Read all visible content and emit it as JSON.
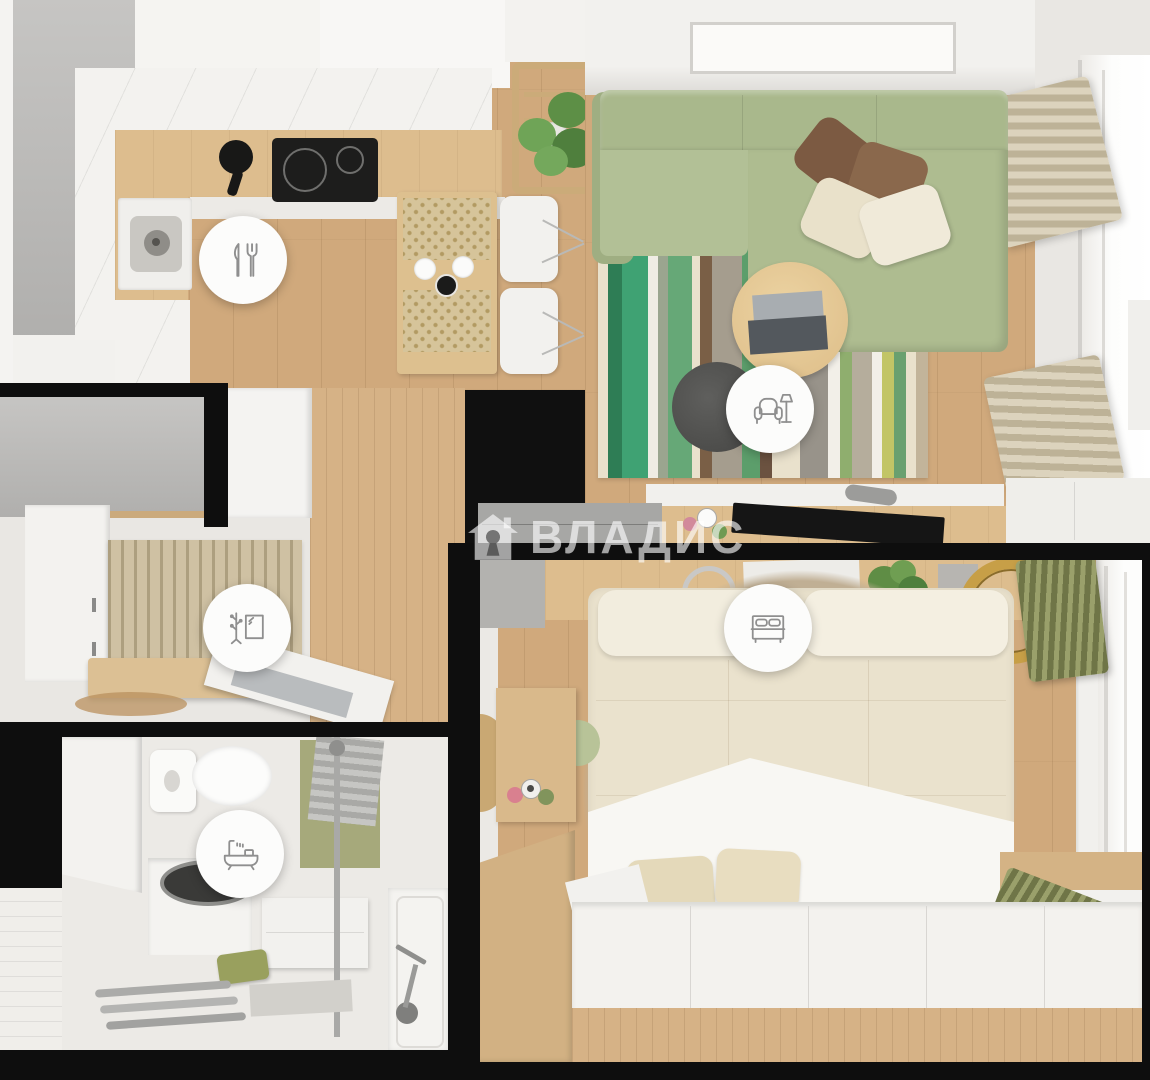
{
  "watermark": {
    "text": "ВЛАДИС",
    "logo": "house-keyhole-icon",
    "color": "#ffffff",
    "opacity": 0.62
  },
  "badges": [
    {
      "room": "kitchen-dining",
      "icon": "cutlery-icon"
    },
    {
      "room": "living-room",
      "icon": "armchair-floor-lamp-icon"
    },
    {
      "room": "hallway-wardrobe",
      "icon": "coat-rack-mirror-icon"
    },
    {
      "room": "bathroom",
      "icon": "bathtub-shower-icon"
    },
    {
      "room": "bedroom",
      "icon": "double-bed-icon"
    }
  ],
  "palette": {
    "wood_floor": "#d0a97c",
    "kitchen_counter": "#ddbd8e",
    "cabinet_white": "#f2f1ee",
    "wall_gray": "#b9b8b6",
    "wall_black": "#0e0e0e",
    "sofa_green": "#aebc90",
    "rug_stripe_greens": [
      "#2e7d55",
      "#3fa273",
      "#66a877",
      "#8fae6e",
      "#c2c566"
    ],
    "bedroom_rug_tan": "#c4b399",
    "duvet_cream": "#eae2cd",
    "blanket_white": "#f8f7f3",
    "curtain_olive": "#868c58",
    "curtain_beige": "#cfc5ab",
    "badge_background": "#fcfcfb",
    "badge_icon_gray": "#8f8f8f"
  }
}
